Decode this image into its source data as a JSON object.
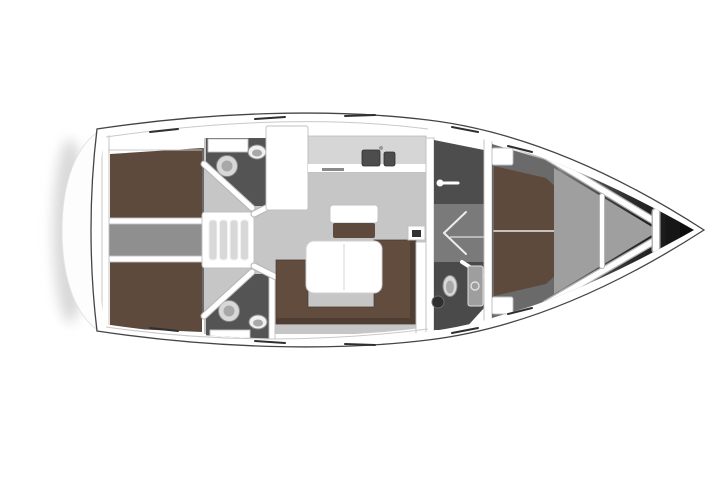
{
  "illustration": {
    "type": "yacht-floor-plan",
    "view": "top-down",
    "orientation": "bow-right-stern-left",
    "alt": "Top-view interior layout plan of a sailing yacht"
  },
  "colors": {
    "canvas": "#ffffff",
    "hull_fill": "#ffffff",
    "hull_stroke": "#454545",
    "platform_fill": "#fdfdfd",
    "platform_edge": "#e4e4e4",
    "platform_shadow": "#d9d9d9",
    "salon_floor": "#c6c6c6",
    "cabin_floor": "#6a6a6a",
    "corridor_floor": "#8f8f8f",
    "passage_floor": "#7a7a7a",
    "head_floor": "#545454",
    "fwd_compartment_floor": "#4d4d4d",
    "fwd_head_floor": "#4a4a4a",
    "anchor_locker_floor": "#9f9f9f",
    "berth_brown": "#5d4a3c",
    "sofa_brown": "#614c3e",
    "sofa_shadow": "#4e3e33",
    "table_top": "#ffffff",
    "seat_base_brown": "#5d4a3c",
    "galley_block": "#fafafa",
    "counter_top": "#d6d6d6",
    "counter_front": "#ffffff",
    "sink_dark": "#4d4d4d",
    "stove_mark": "#8a8a8a",
    "step_frame": "#ffffff",
    "steps_gray": "#d8d8d8",
    "fixture_light": "#d8d8d8",
    "fixture_mid": "#a8a8a8",
    "fixture_white": "#f0f0f0",
    "fixture_dark": "#2f2f2f",
    "shower_tray": "#9e9e9e",
    "instrument_dark": "#333333",
    "wall_white": "#ffffff"
  }
}
